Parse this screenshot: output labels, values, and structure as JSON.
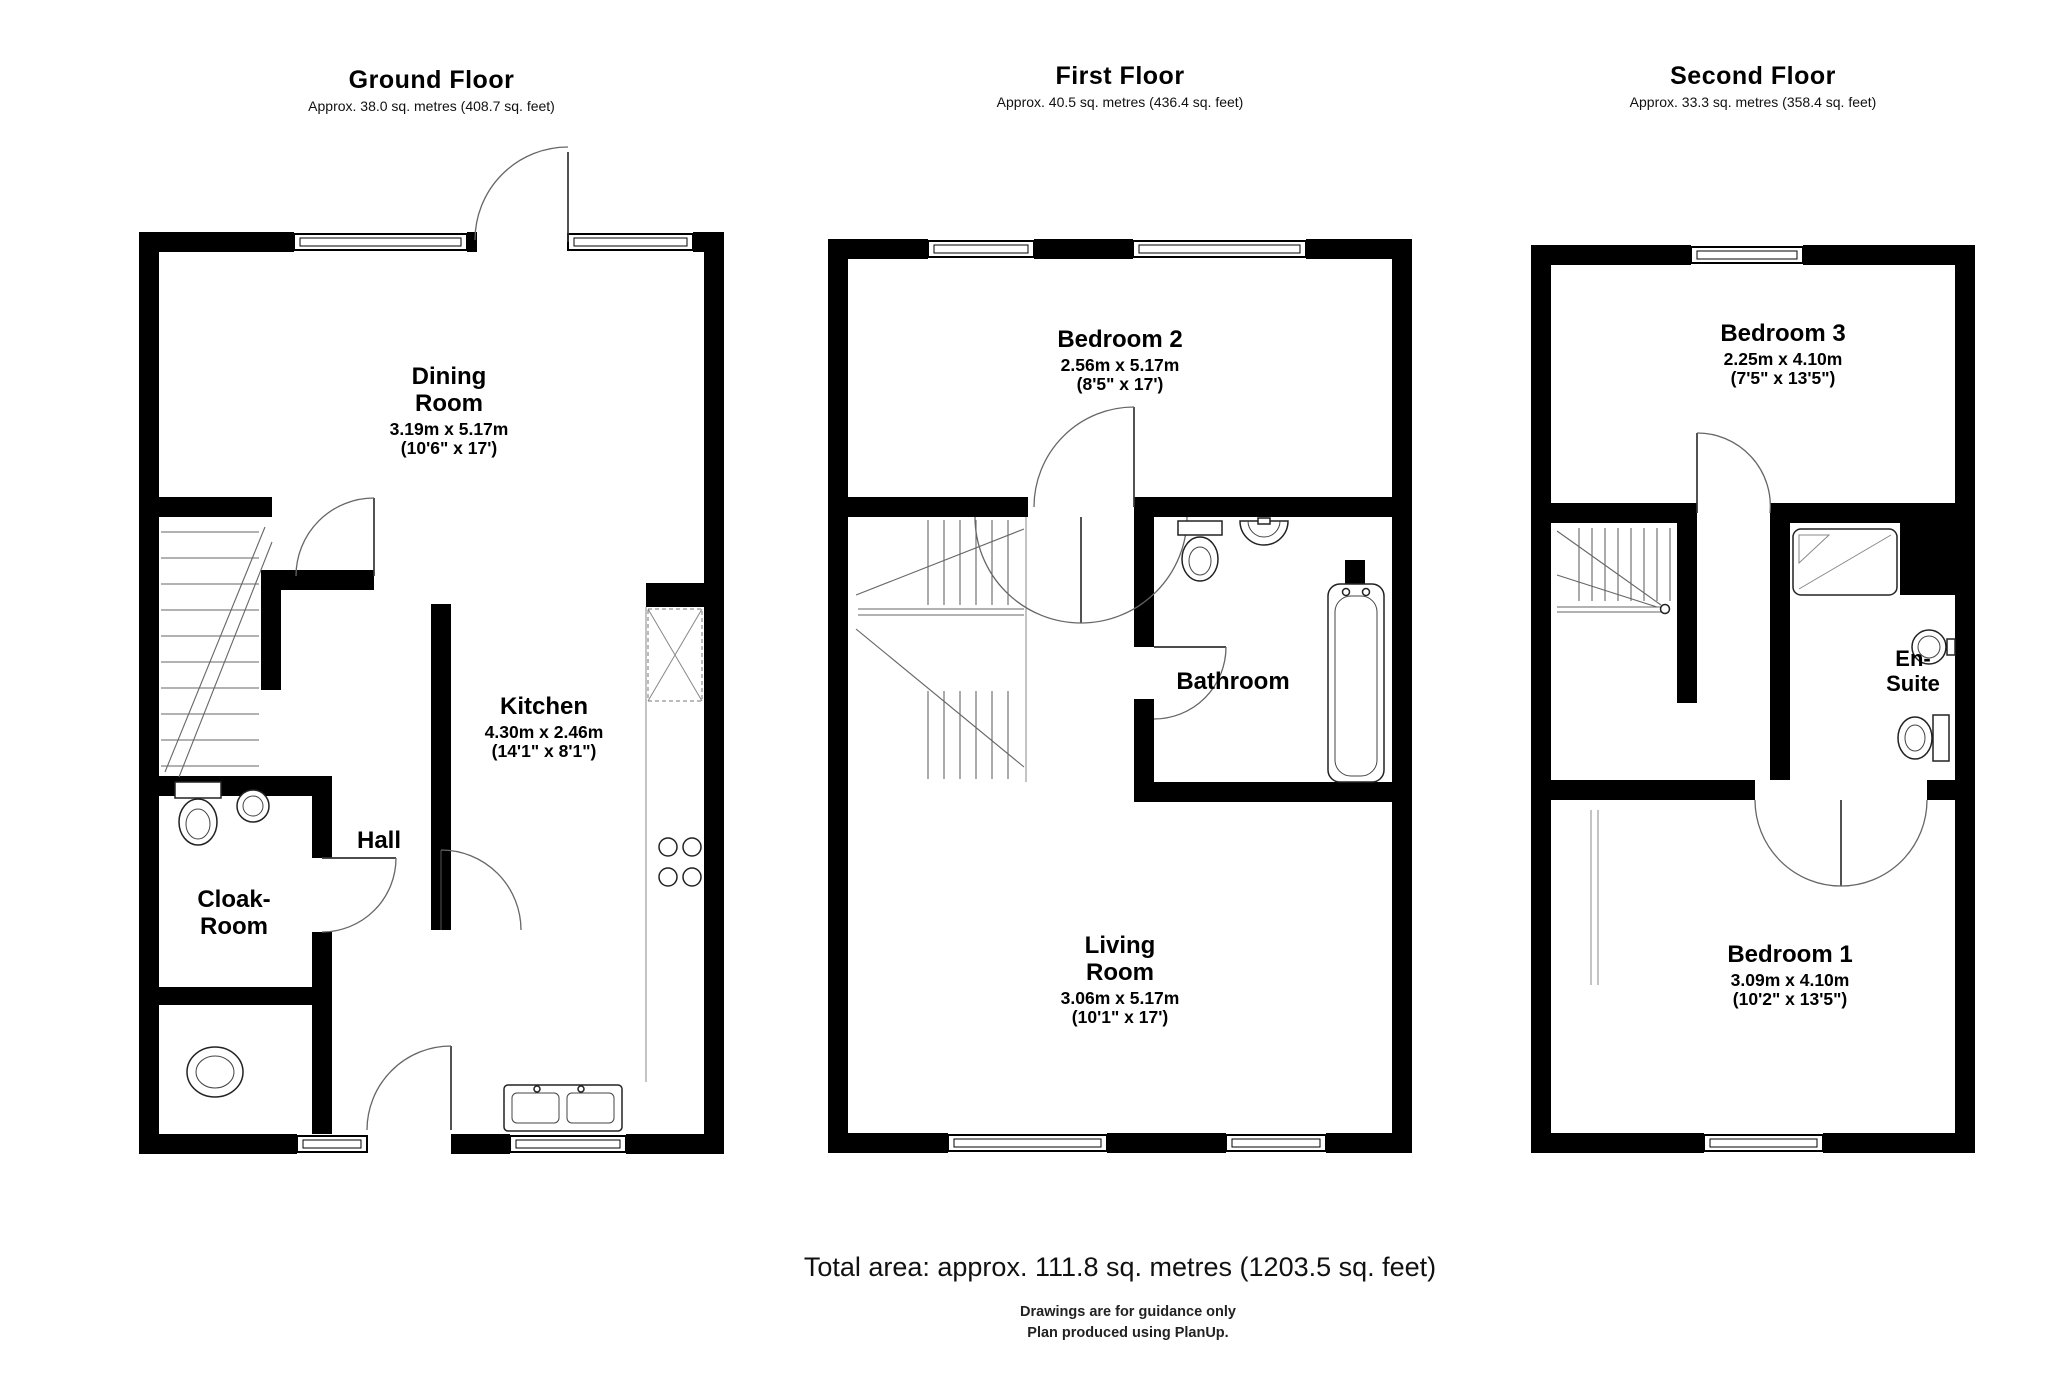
{
  "page": {
    "total_area": "Total area: approx. 111.8 sq. metres (1203.5 sq. feet)",
    "footer_line1": "Drawings are for guidance only",
    "footer_line2": "Plan produced using PlanUp.",
    "wall_color": "#000000",
    "background": "#ffffff"
  },
  "floors": [
    {
      "title": "Ground Floor",
      "area": "Approx. 38.0 sq. metres (408.7 sq. feet)",
      "rooms": [
        {
          "name": "Dining Room",
          "metric": "3.19m x 5.17m",
          "imperial": "(10'6\" x 17')"
        },
        {
          "name": "Kitchen",
          "metric": "4.30m x 2.46m",
          "imperial": "(14'1\" x 8'1\")"
        },
        {
          "name": "Hall",
          "metric": "",
          "imperial": ""
        },
        {
          "name": "Cloak-Room",
          "metric": "",
          "imperial": ""
        }
      ]
    },
    {
      "title": "First Floor",
      "area": "Approx. 40.5 sq. metres (436.4 sq. feet)",
      "rooms": [
        {
          "name": "Bedroom 2",
          "metric": "2.56m x 5.17m",
          "imperial": "(8'5\" x 17')"
        },
        {
          "name": "Bathroom",
          "metric": "",
          "imperial": ""
        },
        {
          "name": "Living Room",
          "metric": "3.06m x 5.17m",
          "imperial": "(10'1\" x 17')"
        }
      ]
    },
    {
      "title": "Second Floor",
      "area": "Approx. 33.3 sq. metres (358.4 sq. feet)",
      "rooms": [
        {
          "name": "Bedroom 3",
          "metric": "2.25m x 4.10m",
          "imperial": "(7'5\" x 13'5\")"
        },
        {
          "name": "En-Suite",
          "metric": "",
          "imperial": ""
        },
        {
          "name": "Bedroom 1",
          "metric": "3.09m x 4.10m",
          "imperial": "(10'2\" x 13'5\")"
        }
      ]
    }
  ]
}
